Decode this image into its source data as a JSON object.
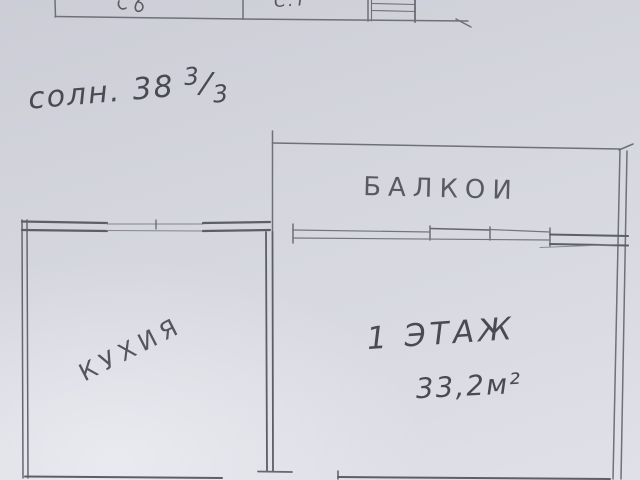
{
  "colors": {
    "paper_dark": "#cccdd6",
    "paper_light": "#e0e1e8",
    "pencil_line": "#6f7078",
    "pencil_heavy": "#5d5e66",
    "ink_text": "#4a4a53"
  },
  "upper_plan": {
    "room_label": "С.Т"
  },
  "address": {
    "prefix": "солн. 38",
    "fraction_numerator": "3",
    "fraction_slash": "/",
    "fraction_denominator": "3"
  },
  "floor_plan": {
    "balcony_label": "БАЛКОИ",
    "kitchen_label": "КУХИЯ",
    "floor_label": "1 ЭТАЖ",
    "area_label": "33,2м²"
  }
}
